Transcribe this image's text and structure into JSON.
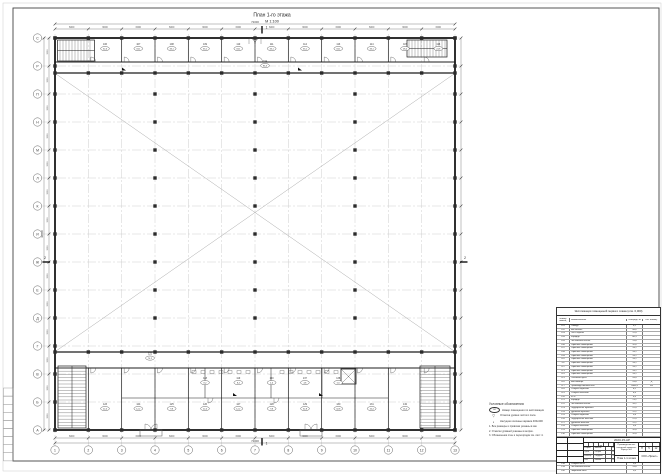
{
  "sheet": {
    "title": "План 1-го этажа",
    "scale": "М 1:100"
  },
  "axes": {
    "cols": [
      "1",
      "2",
      "3",
      "4",
      "5",
      "6",
      "7",
      "8",
      "9",
      "10",
      "11",
      "12",
      "13"
    ],
    "rows": [
      "А",
      "Б",
      "В",
      "Г",
      "Д",
      "Е",
      "Ж",
      "И",
      "К",
      "Л",
      "М",
      "Н",
      "П",
      "Р",
      "С"
    ]
  },
  "dims": {
    "bay_w": "6000",
    "total_w": "72000",
    "bay_h": "3000",
    "total_h": "42000"
  },
  "sections": {
    "v": "1",
    "h": "2"
  },
  "tags": {
    "top": [
      {
        "n": "106",
        "a": "32,6"
      },
      {
        "n": "107",
        "a": "33,1"
      },
      {
        "n": "108",
        "a": "33,1"
      },
      {
        "n": "109",
        "a": "33,1"
      },
      {
        "n": "110",
        "a": "33,1"
      },
      {
        "n": "111",
        "a": "33,1"
      },
      {
        "n": "112",
        "a": "33,1"
      },
      {
        "n": "113",
        "a": "33,1"
      },
      {
        "n": "114",
        "a": "33,1"
      },
      {
        "n": "115",
        "a": "28,4"
      },
      {
        "n": "116",
        "a": "24,8"
      }
    ],
    "bottom": [
      {
        "n": "123",
        "a": "22,4"
      },
      {
        "n": "124",
        "a": "12,2"
      },
      {
        "n": "125",
        "a": "9,8"
      },
      {
        "n": "126",
        "a": "22,4"
      },
      {
        "n": "127",
        "a": "12,2"
      },
      {
        "n": "128",
        "a": "9,8"
      },
      {
        "n": "129",
        "a": "32,8"
      },
      {
        "n": "130",
        "a": "32,8"
      },
      {
        "n": "131",
        "a": "16,4"
      },
      {
        "n": "132",
        "a": "16,4"
      }
    ],
    "upper": [
      {
        "n": "118",
        "a": "8,2"
      },
      {
        "n": "119",
        "a": "8,4"
      },
      {
        "n": "120",
        "a": "4,6"
      },
      {
        "n": "137",
        "a": "4,8"
      },
      {
        "n": "138",
        "a": "5,6"
      }
    ],
    "corridor_top": {
      "n": "104",
      "a": "86,3"
    },
    "corridor_bottom": {
      "n": "121",
      "a": "74,2"
    }
  },
  "legend": {
    "title": "Условные обозначения:",
    "items": [
      {
        "symbol": "101",
        "text": "Номер помещения по экспликации"
      },
      {
        "symbol": "▽",
        "text": "Отметка уровня чистого пола"
      },
      {
        "symbol": "▪",
        "text": "Несущие колонны каркаса 400х400"
      }
    ],
    "notes": [
      "1. Все размеры и привязки указаны в мм.",
      "2. Отметки уровней указаны в метрах.",
      "3. Обозначения стен и перегородок см. лист 4."
    ]
  },
  "schedule": {
    "title": "Экспликация помещений первого этажа (отм. 0,000)",
    "headers": [
      "Номер помещ.",
      "Наименование",
      "Площадь, м²",
      "Кат. помещ."
    ],
    "rows": [
      [
        "101",
        "Тамбур",
        "6,2",
        ""
      ],
      [
        "102",
        "Вестибюль",
        "48,6",
        ""
      ],
      [
        "103",
        "Пост охраны",
        "12,4",
        ""
      ],
      [
        "104",
        "Коридор",
        "86,3",
        ""
      ],
      [
        "105",
        "Лестничная клетка",
        "15,8",
        ""
      ],
      [
        "106",
        "Офисное помещение",
        "32,6",
        ""
      ],
      [
        "107",
        "Офисное помещение",
        "33,1",
        ""
      ],
      [
        "108",
        "Офисное помещение",
        "33,1",
        ""
      ],
      [
        "109",
        "Офисное помещение",
        "33,1",
        ""
      ],
      [
        "110",
        "Офисное помещение",
        "33,1",
        ""
      ],
      [
        "111",
        "Офисное помещение",
        "33,1",
        ""
      ],
      [
        "112",
        "Офисное помещение",
        "33,1",
        ""
      ],
      [
        "113",
        "Офисное помещение",
        "33,1",
        ""
      ],
      [
        "114",
        "Офисное помещение",
        "33,1",
        ""
      ],
      [
        "115",
        "Тепловой пункт",
        "28,4",
        ""
      ],
      [
        "116",
        "Венткамера",
        "24,8",
        "Д"
      ],
      [
        "117",
        "Производственный зал",
        "2860,4",
        "В3"
      ],
      [
        "118",
        "Санузел мужской",
        "8,2",
        ""
      ],
      [
        "119",
        "Санузел женский",
        "8,4",
        ""
      ],
      [
        "120",
        "КУИ",
        "4,6",
        ""
      ],
      [
        "121",
        "Коридор",
        "74,2",
        ""
      ],
      [
        "122",
        "Лестничная клетка",
        "16,2",
        ""
      ],
      [
        "123",
        "Гардеробная мужская",
        "22,4",
        ""
      ],
      [
        "124",
        "Душевая мужская",
        "12,2",
        ""
      ],
      [
        "125",
        "Санузел мужской",
        "9,8",
        ""
      ],
      [
        "126",
        "Гардеробная женская",
        "22,4",
        ""
      ],
      [
        "127",
        "Душевая женская",
        "12,2",
        ""
      ],
      [
        "128",
        "Санузел женский",
        "9,8",
        ""
      ],
      [
        "129",
        "Офисное помещение",
        "32,8",
        ""
      ],
      [
        "130",
        "Офисное помещение",
        "32,8",
        ""
      ],
      [
        "131",
        "Кабинет мастера",
        "16,4",
        ""
      ],
      [
        "132",
        "Кабинет начальника цеха",
        "16,4",
        ""
      ],
      [
        "133",
        "Комната приема пищи",
        "24,6",
        ""
      ],
      [
        "134",
        "Лаборатория",
        "34,2",
        ""
      ],
      [
        "135",
        "Серверная",
        "10,8",
        "В4"
      ],
      [
        "136",
        "Архив",
        "12,4",
        ""
      ],
      [
        "137",
        "КУИ",
        "4,8",
        ""
      ],
      [
        "138",
        "Санузел МГН",
        "5,6",
        ""
      ],
      [
        "139",
        "Лестничная клетка",
        "15,8",
        ""
      ],
      [
        "140",
        "Лифтовой холл",
        "9,6",
        ""
      ],
      [
        "141",
        "Тамбур",
        "5,4",
        ""
      ]
    ],
    "total": [
      "",
      "Итого по этажу",
      "3782,6",
      ""
    ]
  },
  "stamp": {
    "code": "2023-15-АР",
    "cols": [
      "Изм.",
      "Кол.уч",
      "Лист",
      "№ док.",
      "Подп.",
      "Дата"
    ],
    "sig": [
      {
        "role": "Разраб.",
        "name": "Иванов",
        "date": "05.23"
      },
      {
        "role": "Пров.",
        "name": "Петров",
        "date": "05.23"
      },
      {
        "role": "Н.контр.",
        "name": "Сидоров",
        "date": "05.23"
      },
      {
        "role": "ГИП",
        "name": "Козлов",
        "date": "05.23"
      }
    ],
    "object1": "Производственно-складской комплекс.",
    "object2": "Корпус №1",
    "sheet_title": "План 1-го этажа",
    "stage_label": "Стадия",
    "sheet_label": "Лист",
    "sheets_label": "Листов",
    "stage": "П",
    "sheet_no": "5",
    "sheets": "12",
    "org": "ООО «Проект»"
  }
}
